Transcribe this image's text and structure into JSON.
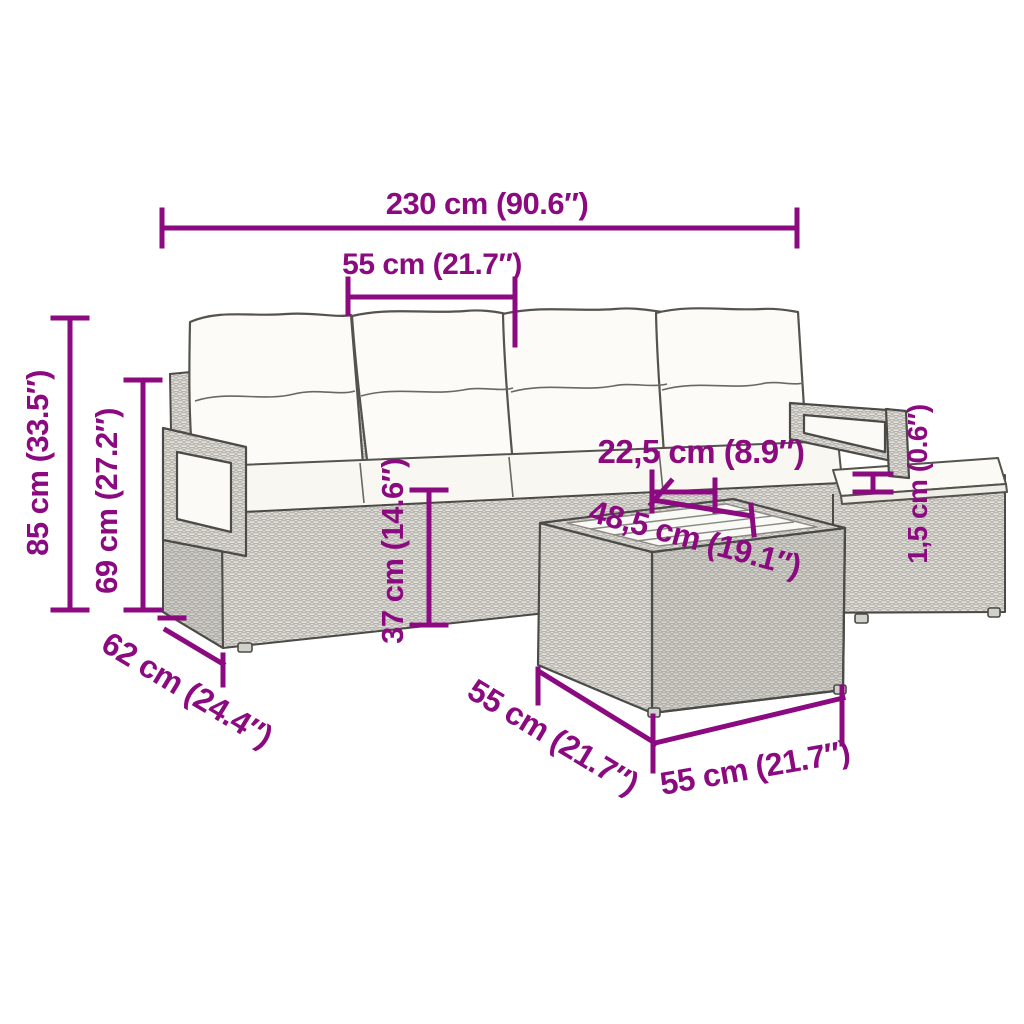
{
  "diagram": {
    "type": "product-dimension-diagram",
    "subject": "poly rattan garden lounge set: 4-seat sofa with back cushions, armrests, ottoman and glass-top coffee table",
    "accent_color": "#8B0A80",
    "background_color": "#ffffff",
    "dimensions": [
      {
        "id": "overall-width",
        "label": "230 cm (90.6″)"
      },
      {
        "id": "seat-width",
        "label": "55 cm (21.7″)"
      },
      {
        "id": "overall-height",
        "label": "85 cm (33.5″)"
      },
      {
        "id": "backrest-height",
        "label": "69 cm (27.2″)"
      },
      {
        "id": "seat-height",
        "label": "37 cm (14.6″)"
      },
      {
        "id": "armrest-clearance",
        "label": "22,5 cm (8.9″)"
      },
      {
        "id": "glass-top-width",
        "label": "48,5 cm (19.1″)"
      },
      {
        "id": "cushion-thickness",
        "label": "1,5 cm (0.6″)"
      },
      {
        "id": "sofa-depth",
        "label": "62 cm (24.4″)"
      },
      {
        "id": "table-depth",
        "label": "55 cm (21.7″)"
      },
      {
        "id": "table-width",
        "label": "55 cm (21.7″)"
      }
    ]
  }
}
